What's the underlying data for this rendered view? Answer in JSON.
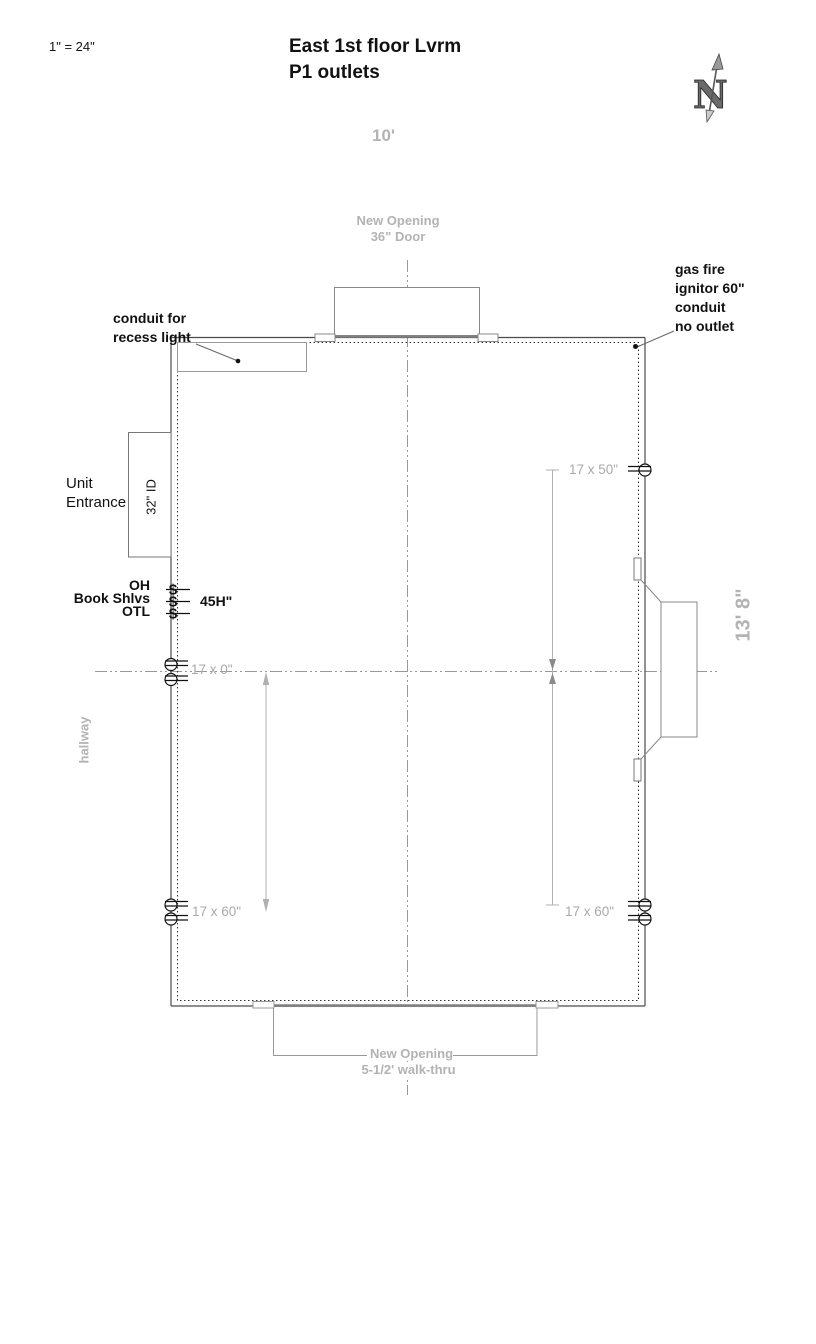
{
  "header": {
    "scale_note": "1\" = 24\"",
    "title": "East 1st floor Lvrm\nP1 outlets"
  },
  "compass": {
    "letter": "N"
  },
  "plan": {
    "top_dimension": "10'",
    "right_dimension": "13' 8\"",
    "top_opening": "New Opening\n36\" Door",
    "bottom_opening": "New Opening\n5-1/2' walk-thru",
    "hallway_label": "hallway",
    "annotations": {
      "recess_conduit": "conduit for\nrecess light",
      "gas_fire": "gas fire\nignitor 60\"\nconduit\nno outlet",
      "unit_entrance": "Unit\nEntrance",
      "entrance_width": "32\" ID",
      "shelves": "OH\nBook Shlvs\nOTL",
      "shelf_height": "45H\"",
      "switch_symbol": "$"
    },
    "outlet_dimensions": {
      "mid_left": "17 x 0\"",
      "upper_right": "17 x 50\"",
      "lower_left": "17 x 60\"",
      "lower_right": "17 x 60\""
    }
  },
  "colors": {
    "wall_line": "#4a4a4a",
    "secondary_line": "#888888",
    "opening_line": "#808080",
    "dimension_line": "#b0b0b0",
    "centerline": "#999999",
    "gray_label": "#b3b3b3",
    "dim_text": "#a9a9a9",
    "symbol_black": "#111111"
  }
}
